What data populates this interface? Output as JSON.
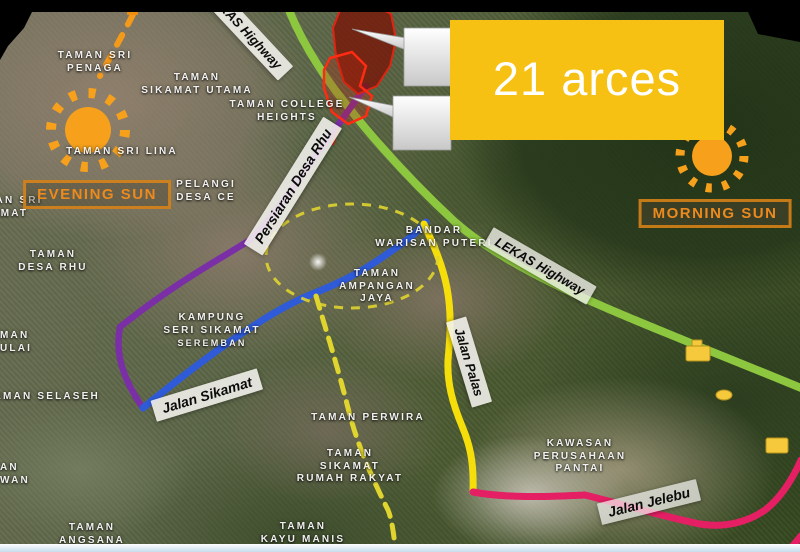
{
  "annotation": {
    "area_label": "21 arces"
  },
  "suns": {
    "evening_label": "EVENING SUN",
    "morning_label": "MORNING SUN"
  },
  "road_labels": [
    {
      "key": "lekas-highway-top",
      "text": "LEKAS Highway"
    },
    {
      "key": "lekas-highway-mid",
      "text": "LEKAS Highway"
    },
    {
      "key": "persiaran-desa-rhu",
      "text": "Persiaran Desa Rhu"
    },
    {
      "key": "jalan-sikamat",
      "text": "Jalan Sikamat"
    },
    {
      "key": "jalan-palas",
      "text": "Jalan Palas"
    },
    {
      "key": "jalan-jelebu",
      "text": "Jalan Jelebu"
    }
  ],
  "place_labels": [
    {
      "lines": [
        "TAMAN SRI",
        "PENAGA"
      ]
    },
    {
      "lines": [
        "TAMAN",
        "SIKAMAT UTAMA"
      ]
    },
    {
      "lines": [
        "TAMAN SRI",
        "SIKAMAT"
      ]
    },
    {
      "lines": [
        "TAMAN SRI LINA"
      ]
    },
    {
      "lines": [
        "PELANGI",
        "DESA CE"
      ]
    },
    {
      "lines": [
        "TAMAN COLLEGE",
        "HEIGHTS"
      ]
    },
    {
      "lines": [
        "TAMAN",
        "DESA RHU"
      ]
    },
    {
      "lines": [
        "KAMPUNG",
        "SERI SIKAMAT",
        "SEREMBAN"
      ]
    },
    {
      "lines": [
        "BANDAR",
        "WARISAN PUTERI"
      ]
    },
    {
      "lines": [
        "TAMAN",
        "AMPANGAN",
        "JAYA"
      ]
    },
    {
      "lines": [
        "TAMAN SELASEH"
      ]
    },
    {
      "lines": [
        "MAN",
        "ULAI"
      ]
    },
    {
      "lines": [
        "AN",
        "WAN"
      ]
    },
    {
      "lines": [
        "TAMAN PERWIRA"
      ]
    },
    {
      "lines": [
        "TAMAN",
        "SIKAMAT",
        "RUMAH RAKYAT"
      ]
    },
    {
      "lines": [
        "KAWASAN",
        "PERUSAHAAN",
        "PANTAI"
      ]
    },
    {
      "lines": [
        "TAMAN",
        "ANGSANA"
      ]
    },
    {
      "lines": [
        "TAMAN",
        "KAYU MANIS"
      ]
    }
  ],
  "colors": {
    "lekas_highway_green": "#8dc63f",
    "boundary_purple": "#7b2fa6",
    "jalan_sikamat_blue": "#2f5bd8",
    "jalan_palas_yellow": "#f5de0a",
    "proposed_dashed_yellow": "#e0d42f",
    "jalan_jelebu_pink": "#e41f63",
    "site_red": "#e02412",
    "sun_orange": "#f6a01c",
    "area_box_yellow": "#f6c113",
    "sun_label_orange": "#ec8a1e"
  }
}
